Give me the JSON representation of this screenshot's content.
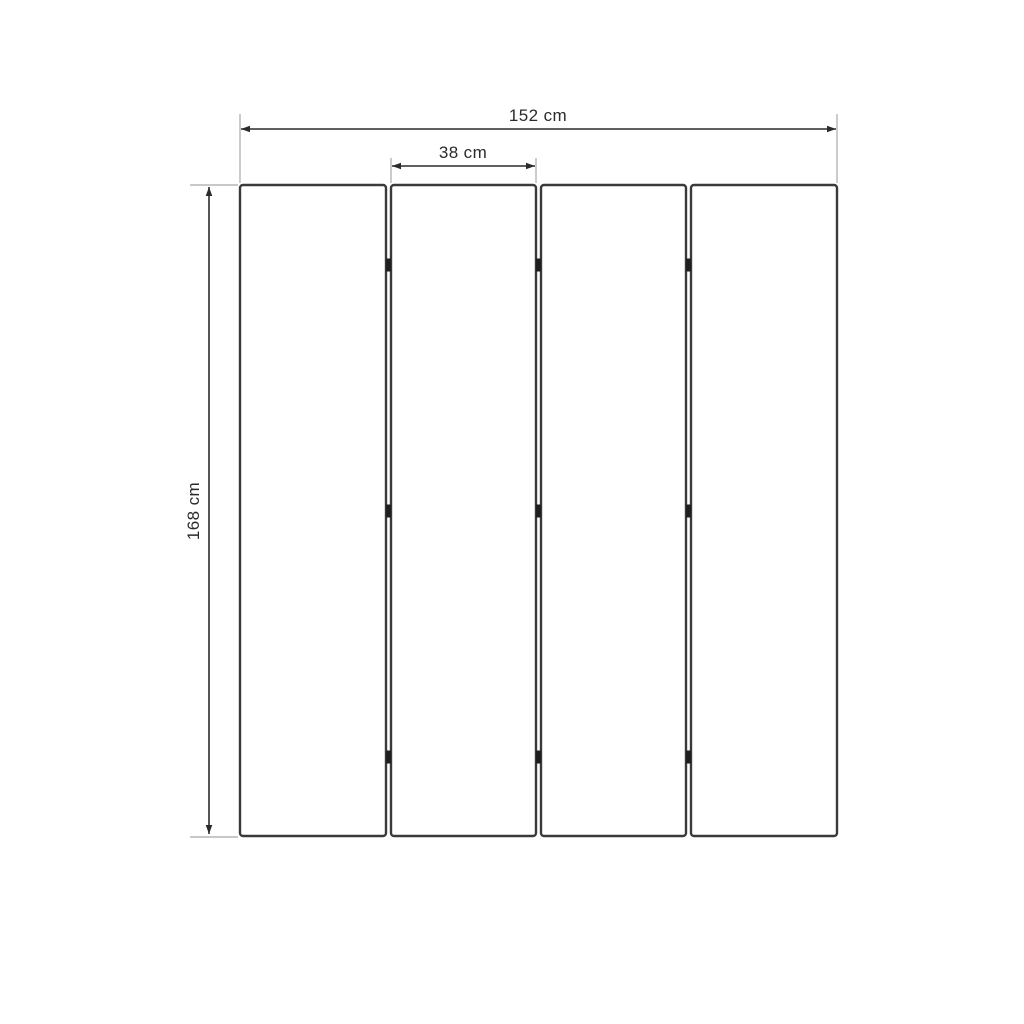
{
  "diagram": {
    "type": "dimension-drawing",
    "subject": "four-panel folding screen front view with dimensions",
    "panel_count": 4,
    "hinges_per_gap": 3,
    "dimensions": {
      "total_width": "152 cm",
      "panel_width": "38 cm",
      "height": "168 cm"
    },
    "colors": {
      "background": "#ffffff",
      "panel_fill": "#ffffff",
      "panel_stroke": "#3a3a3a",
      "dimension_line": "#2b2b2b",
      "extension_line": "#a8a8a8",
      "hinge": "#1f1f1f",
      "label_text": "#2b2b2b"
    }
  }
}
